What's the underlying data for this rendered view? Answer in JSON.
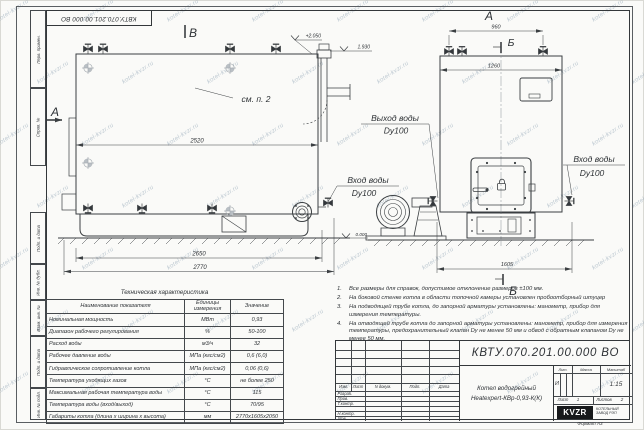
{
  "watermark": {
    "text": "kotel-kvzr.ru"
  },
  "frame": {
    "corner_stamp": "КВТУ.070.201.00.000 ВО",
    "margin": [
      "Перв. примен.",
      "Справ. №",
      "Подп. и дата",
      "Инв. № дубл.",
      "Взам. инв. №",
      "Подп. и дата",
      "Инв. № подл."
    ],
    "format_note": "Формат А3"
  },
  "drawing": {
    "view_labels": {
      "b": "В",
      "a": "А"
    },
    "section_labels": {
      "a": "А",
      "b": "Б"
    },
    "see_note": "см. п. 2",
    "elevations": {
      "top": "+2.050",
      "mid": "1.930",
      "ground": "0.000"
    },
    "dims": {
      "d2520": "2520",
      "d2650": "2650",
      "d2770": "2770",
      "d960": "960",
      "d1260": "1260",
      "d1605": "1605"
    },
    "labels": {
      "outlet": "Выход воды",
      "outlet_dn": "Dy100",
      "inlet": "Вход воды",
      "inlet_dn": "Dy100"
    }
  },
  "spec_table": {
    "title": "Техническая характеристика",
    "headers": [
      "Наименование показателя",
      "Единицы измерения",
      "Значение"
    ],
    "rows": [
      [
        "Номинальная мощность",
        "МВт",
        "0,93"
      ],
      [
        "Диапазон рабочего регулирования",
        "%",
        "50-100"
      ],
      [
        "Расход воды",
        "м3/ч",
        "32"
      ],
      [
        "Рабочее давление воды",
        "МПа (кгс/см2)",
        "0,6 (6,0)"
      ],
      [
        "Гидравлическое сопротивление котла",
        "МПа (кгс/см2)",
        "0,06 (0,6)"
      ],
      [
        "Температура уходящих газов",
        "°С",
        "не более 250"
      ],
      [
        "Максимальная рабочая температура воды",
        "°С",
        "115"
      ],
      [
        "Температура воды (вход/выход)",
        "°С",
        "70/95"
      ],
      [
        "Габариты котла (длина х ширина х высота)",
        "мм",
        "2770х1605х2050"
      ]
    ]
  },
  "notes": {
    "items": [
      {
        "num": "1.",
        "text": "Все размеры для справок, допустимое отклонение размеров ±100 мм."
      },
      {
        "num": "2.",
        "text": "На боковой стенке котла в области топочной камеры установлен пробоотборный штуцер"
      },
      {
        "num": "3.",
        "text": "На подводящей трубе котла, до запорной арматуры установлены: манометр, прибор для измерения температуры."
      },
      {
        "num": "4.",
        "text": "На отводящей трубе котла до запорной арматуры установлены: манометр, прибор для измерения температуры, предохранительный клапан Dу не менее 50 мм и обвод с обратным клапаном Dу не менее 50 мм."
      }
    ]
  },
  "title_block": {
    "doc_number": "КВТУ.070.201.00.000 ВО",
    "product_name_line1": "Котел водогрейный",
    "product_name_line2": "Heatexpert-КВр-0,93-К(К)",
    "header_cols": [
      "Изм.",
      "Лист",
      "N докум.",
      "Подп.",
      "Дата"
    ],
    "row_labels": [
      "Разраб.",
      "Пров.",
      "Т.контр.",
      "",
      "Н.контр.",
      "Утв."
    ],
    "lit_label": "Лит.",
    "lit_value": "И",
    "mass_label": "Масса",
    "scale_label": "Масштаб",
    "scale_value": "1:15",
    "sheet_label": "Лист",
    "sheet_value": "1",
    "sheets_label": "Листов",
    "sheets_value": "2",
    "logo_text": "KVZR",
    "company_line1": "КОТЕЛЬНЫЙ",
    "company_line2": "ЗАВОД РЭП"
  }
}
